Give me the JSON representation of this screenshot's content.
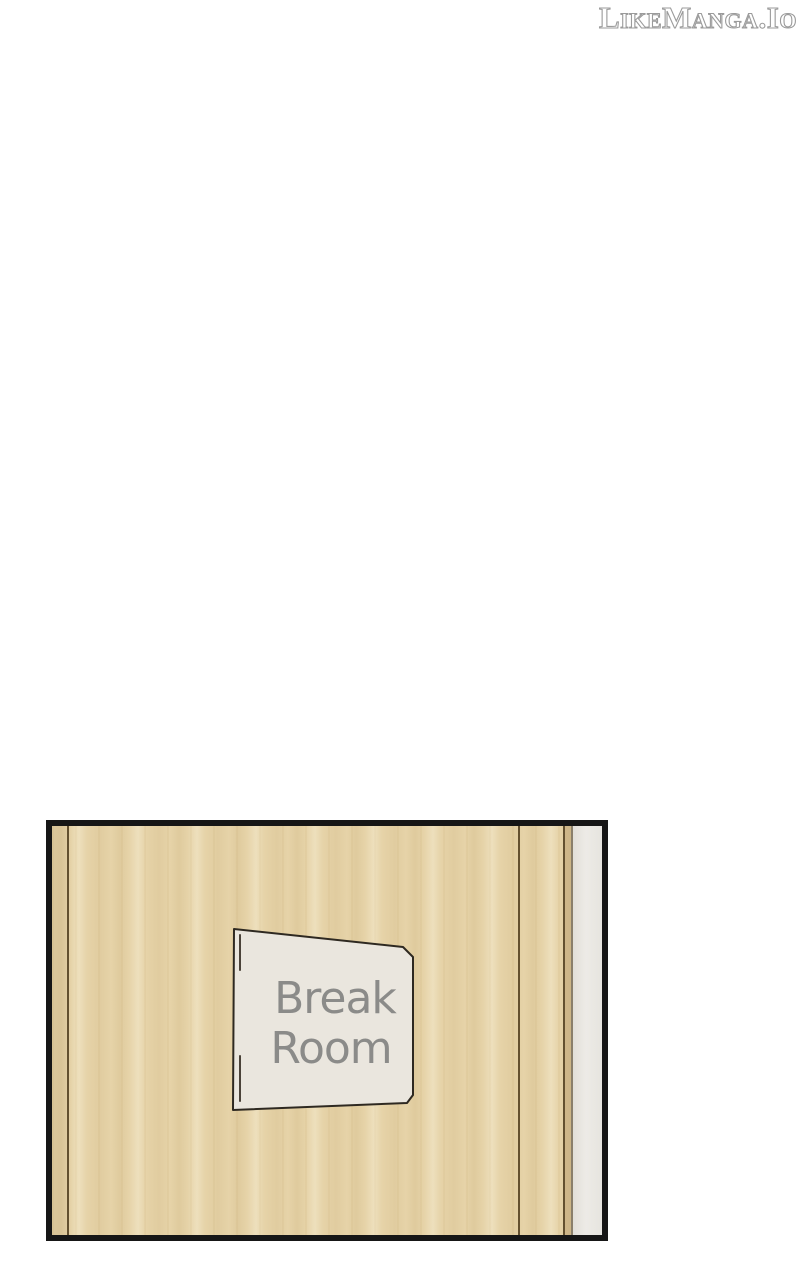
{
  "watermark": {
    "text": "LikeManga.Io",
    "fill_color": "#ffffff",
    "outline_color": "#9b9b9b"
  },
  "panel": {
    "border_color": "#161616",
    "door": {
      "wood_base_color": "#e6d3a8",
      "wood_streak_dark": "#ddc795",
      "wood_streak_light": "#eedcb5",
      "groove_color": "#63502f",
      "wall_strip_color": "#eae8e3",
      "wall_strip_edge_color": "#8a7f6b"
    },
    "sign": {
      "line1": "Break",
      "line2": "Room",
      "plate_color": "#eae6de",
      "outline_color": "#2e2921",
      "hinge_mark_color": "#4a4238",
      "text_color": "#8b8b89"
    }
  }
}
